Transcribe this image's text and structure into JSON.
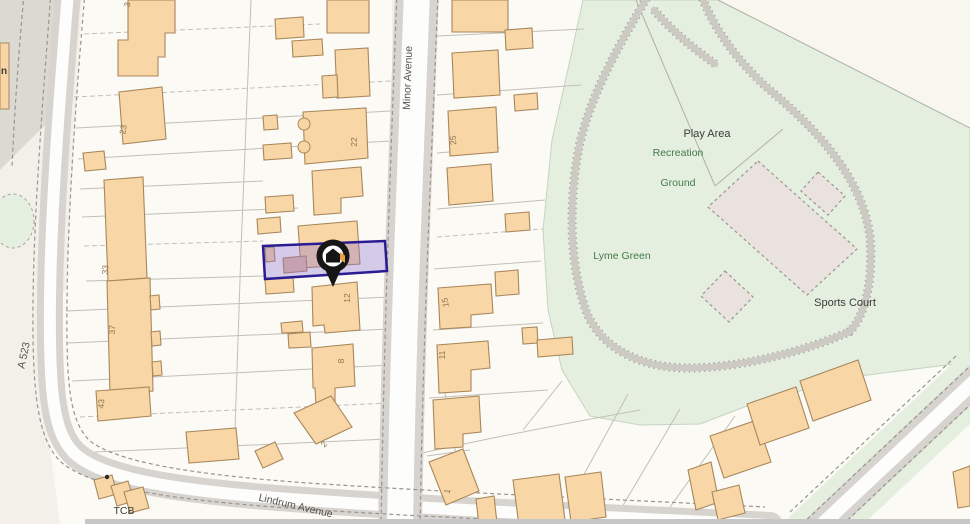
{
  "map": {
    "colors": {
      "bg": "#f2f0e9",
      "plot_fill": "#fbfaf5",
      "verge": "#dcd8d2",
      "road_casing": "#d7d3ce",
      "road_white": "#fdfdfc",
      "road_inner_minor": "#ecled",
      "dash": "#98948f",
      "plot_line": "#c3bfb8",
      "building_fill": "#f8d6a6",
      "building_stroke": "#a8875c",
      "building_alt_fill": "#e3bda1",
      "green": "#e4efe0",
      "green_stroke": "#c6d4c1",
      "cream_triangle": "#f8f7ed",
      "path_gray": "#cdc9c3",
      "path_dot": "#a6a29d",
      "court_fill": "#e9e2df",
      "court_stroke": "#9a968f",
      "fence": "#b3afa8",
      "highlight_fill": "#8f6fce",
      "highlight_stroke": "#2a1c92",
      "label_dark": "#3b3b39",
      "label_green": "#447a4c",
      "label_street": "#55544f",
      "number": "#8f7553",
      "bottom_bar": "#c7c7c9",
      "pin_black": "#161616",
      "pin_orange": "#e8a33d"
    },
    "street_labels": [
      {
        "id": "minor-avenue",
        "text": "Minor Avenue",
        "x": 411,
        "y": 78,
        "rotate": -88,
        "size": 10.5
      },
      {
        "id": "a-523",
        "text": "A 523",
        "x": 27,
        "y": 356,
        "rotate": -78,
        "size": 10.5
      },
      {
        "id": "lindrum-avenue",
        "text": "Lindrum Avenue",
        "x": 295,
        "y": 509,
        "rotate": 13,
        "size": 10.5
      }
    ],
    "area_labels": [
      {
        "id": "play-area",
        "text": "Play Area",
        "x": 707,
        "y": 137,
        "color": "dark",
        "size": 11
      },
      {
        "id": "recreation",
        "text": "Recreation",
        "x": 678,
        "y": 156,
        "color": "green",
        "size": 10.5
      },
      {
        "id": "ground",
        "text": "Ground",
        "x": 678,
        "y": 186,
        "color": "green",
        "size": 10.5
      },
      {
        "id": "lyme-green",
        "text": "Lyme Green",
        "x": 622,
        "y": 259,
        "color": "green",
        "size": 10.5
      },
      {
        "id": "sports-court",
        "text": "Sports Court",
        "x": 845,
        "y": 306,
        "color": "dark",
        "size": 11
      },
      {
        "id": "tcb",
        "text": "TCB",
        "x": 124,
        "y": 514,
        "color": "dark",
        "size": 10.5
      },
      {
        "id": "building-n",
        "text": "n",
        "x": 4,
        "y": 74,
        "color": "dark",
        "size": 10
      }
    ],
    "house_numbers": [
      {
        "text": "3",
        "x": 130,
        "y": 5,
        "rotate": -80
      },
      {
        "text": "23",
        "x": 126,
        "y": 130,
        "rotate": -80
      },
      {
        "text": "33",
        "x": 108,
        "y": 270,
        "rotate": -85
      },
      {
        "text": "37",
        "x": 115,
        "y": 330,
        "rotate": -85
      },
      {
        "text": "43",
        "x": 104,
        "y": 404,
        "rotate": -85
      },
      {
        "text": "22",
        "x": 357,
        "y": 142,
        "rotate": -90
      },
      {
        "text": "12",
        "x": 350,
        "y": 298,
        "rotate": -90
      },
      {
        "text": "8",
        "x": 344,
        "y": 361,
        "rotate": -90
      },
      {
        "text": "2",
        "x": 326,
        "y": 446,
        "rotate": -50
      },
      {
        "text": "25",
        "x": 456,
        "y": 140,
        "rotate": -95
      },
      {
        "text": "15",
        "x": 448,
        "y": 302,
        "rotate": -100
      },
      {
        "text": "11",
        "x": 445,
        "y": 355,
        "rotate": -90
      },
      {
        "text": "1",
        "x": 450,
        "y": 492,
        "rotate": -75
      }
    ],
    "marker": {
      "x": 333,
      "y": 256
    },
    "highlight_plot": {
      "points": "263,246 385,241 387,271 265,279"
    },
    "geometry": {
      "plots_west": "82,0 392,0 392,524 60,524 48,432 52,300 66,290",
      "plots_east": "437,0 583,0 570,60 552,140 543,230 548,310 562,370 590,416 640,425 700,424 760,401 860,376 970,362 970,524 398,524",
      "green_main": "583,0 718,0 970,128 970,362 860,376 760,401 700,424 640,425 590,416 562,370 548,310 543,230 552,140 570,60",
      "green_ellipse": {
        "cx": 13,
        "cy": 221,
        "rx": 21,
        "ry": 27
      },
      "cream_triangle": "718,0 970,0 970,128",
      "verge_left": "0,0 60,0 50,120 0,170",
      "building_n_rect": {
        "x": 0,
        "y": 43,
        "w": 9,
        "h": 66
      },
      "roads": [
        {
          "id": "a523-lindrum",
          "d": "M68,-8 C61,80 51,200 50,300 C49,392 53,432 74,453 C103,481 190,492 305,500 C460,511 610,517 770,525",
          "casing": 26,
          "inner": 12,
          "inner_color": "road_white"
        },
        {
          "id": "minor-avenue",
          "d": "M417,-8 C411,150 403,330 400,530",
          "casing": 44,
          "inner": 26,
          "inner_color": "road_white"
        },
        {
          "id": "southeast-road",
          "d": "M978,378 L812,534",
          "green_under": 56,
          "casing": 30,
          "inner": 14,
          "inner_color": "road_white"
        }
      ],
      "dash_paths": [
        "M51,-8 C44,85 34,205 33,303 C32,395 38,440 61,462 C93,490 185,501 303,509 C455,519 600,524 720,528",
        "M85,-8 C77,85 68,205 67,300 C66,386 70,419 88,439 C112,462 196,475 308,483 C458,493 610,499 765,507",
        "M397,-8 C391,150 384,330 381,530",
        "M438,-8 C432,150 423,330 420,530",
        "M968,368 L802,524",
        "M988,388 L822,544",
        "M956,356 L790,512",
        "M24,-6 C18,60 14,120 12,168"
      ],
      "park_paths": [
        "M649,-6 C622,40 589,95 578,152 C569,205 569,262 586,311 C601,349 642,369 692,368 C744,367 806,351 851,331",
        "M701,-6 C712,26 737,62 772,92 C817,130 862,177 870,237 C874,288 862,321 848,333",
        "M654,10 C673,32 693,48 715,64"
      ],
      "fence_lines": [
        [
          636,
          0,
          715,
          186
        ],
        [
          715,
          186,
          783,
          129
        ],
        [
          718,
          0,
          970,
          128
        ]
      ],
      "courts": [
        "758,161 857,249 807,295 708,207",
        "818,172 845,196 828,215 801,191",
        "725,271 753,297 729,322 701,296"
      ],
      "plot_lines": [
        [
          84,
          34,
          320,
          24,
          1
        ],
        [
          74,
          97,
          391,
          81,
          1
        ],
        [
          76,
          128,
          391,
          111,
          0
        ],
        [
          78,
          159,
          391,
          141,
          0
        ],
        [
          80,
          189,
          263,
          181,
          0
        ],
        [
          82,
          217,
          298,
          208,
          0
        ],
        [
          84,
          246,
          263,
          241,
          1
        ],
        [
          86,
          281,
          265,
          276,
          0
        ],
        [
          66,
          311,
          392,
          297,
          0
        ],
        [
          68,
          343,
          392,
          329,
          0
        ],
        [
          72,
          381,
          392,
          365,
          0
        ],
        [
          80,
          417,
          390,
          403,
          1
        ],
        [
          95,
          452,
          388,
          439,
          0
        ],
        [
          251,
          0,
          241,
          250,
          0
        ],
        [
          241,
          250,
          235,
          430,
          0
        ],
        [
          437,
          36,
          584,
          29,
          0
        ],
        [
          437,
          95,
          581,
          85,
          0
        ],
        [
          437,
          153,
          500,
          148,
          0
        ],
        [
          437,
          209,
          545,
          200,
          0
        ],
        [
          437,
          237,
          543,
          229,
          1
        ],
        [
          434,
          269,
          541,
          261,
          0
        ],
        [
          433,
          330,
          543,
          323,
          0
        ],
        [
          429,
          398,
          548,
          390,
          0
        ],
        [
          427,
          456,
          470,
          450,
          0
        ],
        [
          445,
          393,
          468,
          524,
          0
        ],
        [
          523,
          430,
          562,
          381,
          0
        ],
        [
          570,
          500,
          628,
          394,
          0
        ],
        [
          612,
          524,
          680,
          409,
          0
        ],
        [
          658,
          524,
          735,
          416,
          0
        ]
      ],
      "rear_curve": "M400,458 C470,442 540,428 640,410",
      "buildings": [
        {
          "pts": "128,0 175,0 175,33 165,33 165,57 158,57 158,76 118,76 118,40 128,40"
        },
        {
          "pts": "119,92 162,87 166,139 123,144"
        },
        {
          "pts": "83,153 104,151 106,169 85,171"
        },
        {
          "pts": "104,180 143,177 147,278 108,281"
        },
        {
          "pts": "107,281 150,278 153,391 110,395"
        },
        {
          "pts": "150,296 159,295 160,309 151,310"
        },
        {
          "pts": "151,332 160,331 161,345 152,346"
        },
        {
          "pts": "152,362 161,361 162,375 153,376"
        },
        {
          "pts": "96,391 149,387 151,416 98,421"
        },
        {
          "pts": "94,480 112,475 117,494 99,499"
        },
        {
          "pts": "111,486 128,481 134,501 117,506"
        },
        {
          "pts": "124,492 143,487 149,508 130,513"
        },
        {
          "pts": "186,432 236,428 239,459 189,463"
        },
        {
          "pts": "327,0 369,0 369,33 327,33"
        },
        {
          "pts": "275,19 303,17 304,37 276,39"
        },
        {
          "pts": "292,41 322,39 323,55 293,57"
        },
        {
          "pts": "335,50 368,48 370,96 337,98"
        },
        {
          "pts": "322,76 337,75 338,97 323,98"
        },
        {
          "pts": "263,116 277,115 278,129 264,130"
        },
        {
          "pts": "303,112 366,108 368,158 305,164"
        },
        {
          "pts": "263,145 291,143 292,158 264,160"
        },
        {
          "pts": "312,171 361,167 363,196 341,198 341,213 314,215"
        },
        {
          "pts": "265,197 293,195 294,211 266,213"
        },
        {
          "pts": "257,219 280,217 281,232 258,234"
        },
        {
          "pts": "298,226 357,221 360,264 301,268"
        },
        {
          "pts": "283,258 306,256 307,271 284,273",
          "alt": true
        },
        {
          "pts": "265,248 274,247 275,261 266,262"
        },
        {
          "pts": "265,279 293,277 294,292 266,294"
        },
        {
          "pts": "312,287 357,282 360,330 325,333 324,325 313,326"
        },
        {
          "pts": "281,323 302,321 303,332 282,333"
        },
        {
          "pts": "288,334 310,332 311,347 289,348"
        },
        {
          "pts": "312,348 353,344 355,386 335,388 335,403 316,405 315,388 313,388"
        },
        {
          "pts": "294,413 331,396 352,427 316,444"
        },
        {
          "pts": "255,451 275,442 283,459 263,468"
        },
        {
          "pts": "452,0 508,0 508,32 452,32"
        },
        {
          "pts": "505,30 532,28 533,48 506,50"
        },
        {
          "pts": "452,53 498,50 500,95 454,98"
        },
        {
          "pts": "514,95 537,93 538,109 515,111"
        },
        {
          "pts": "448,111 496,107 498,152 450,156"
        },
        {
          "pts": "447,168 491,164 493,201 449,205"
        },
        {
          "pts": "505,214 529,212 530,230 506,232"
        },
        {
          "pts": "438,288 491,284 493,313 471,315 471,327 440,329"
        },
        {
          "pts": "495,272 518,270 519,294 496,296"
        },
        {
          "pts": "437,345 488,341 490,368 471,370 471,391 439,393"
        },
        {
          "pts": "433,400 479,396 481,432 463,434 463,447 435,449"
        },
        {
          "pts": "429,462 463,449 479,491 446,505"
        },
        {
          "pts": "522,328 537,327 538,343 523,344"
        },
        {
          "pts": "537,340 572,337 573,354 538,357"
        },
        {
          "pts": "476,499 494,496 497,523 479,526"
        },
        {
          "pts": "513,480 559,474 565,520 519,526"
        },
        {
          "pts": "565,477 601,472 606,517 571,522"
        },
        {
          "pts": "688,470 711,462 719,502 696,510"
        },
        {
          "pts": "712,492 739,485 745,513 718,520"
        },
        {
          "pts": "710,436 757,420 771,462 724,478"
        },
        {
          "pts": "747,404 796,387 809,428 760,445"
        },
        {
          "pts": "800,381 858,360 871,400 813,421"
        },
        {
          "pts": "953,472 970,466 970,506 958,508"
        }
      ],
      "bay_bumps": [
        {
          "cx": 304,
          "cy": 124,
          "r": 6
        },
        {
          "cx": 304,
          "cy": 147,
          "r": 6
        }
      ],
      "dot": {
        "cx": 107,
        "cy": 477,
        "r": 2.2
      },
      "bottom_bar": {
        "x": 85,
        "y": 519,
        "w": 885,
        "h": 5
      }
    }
  }
}
